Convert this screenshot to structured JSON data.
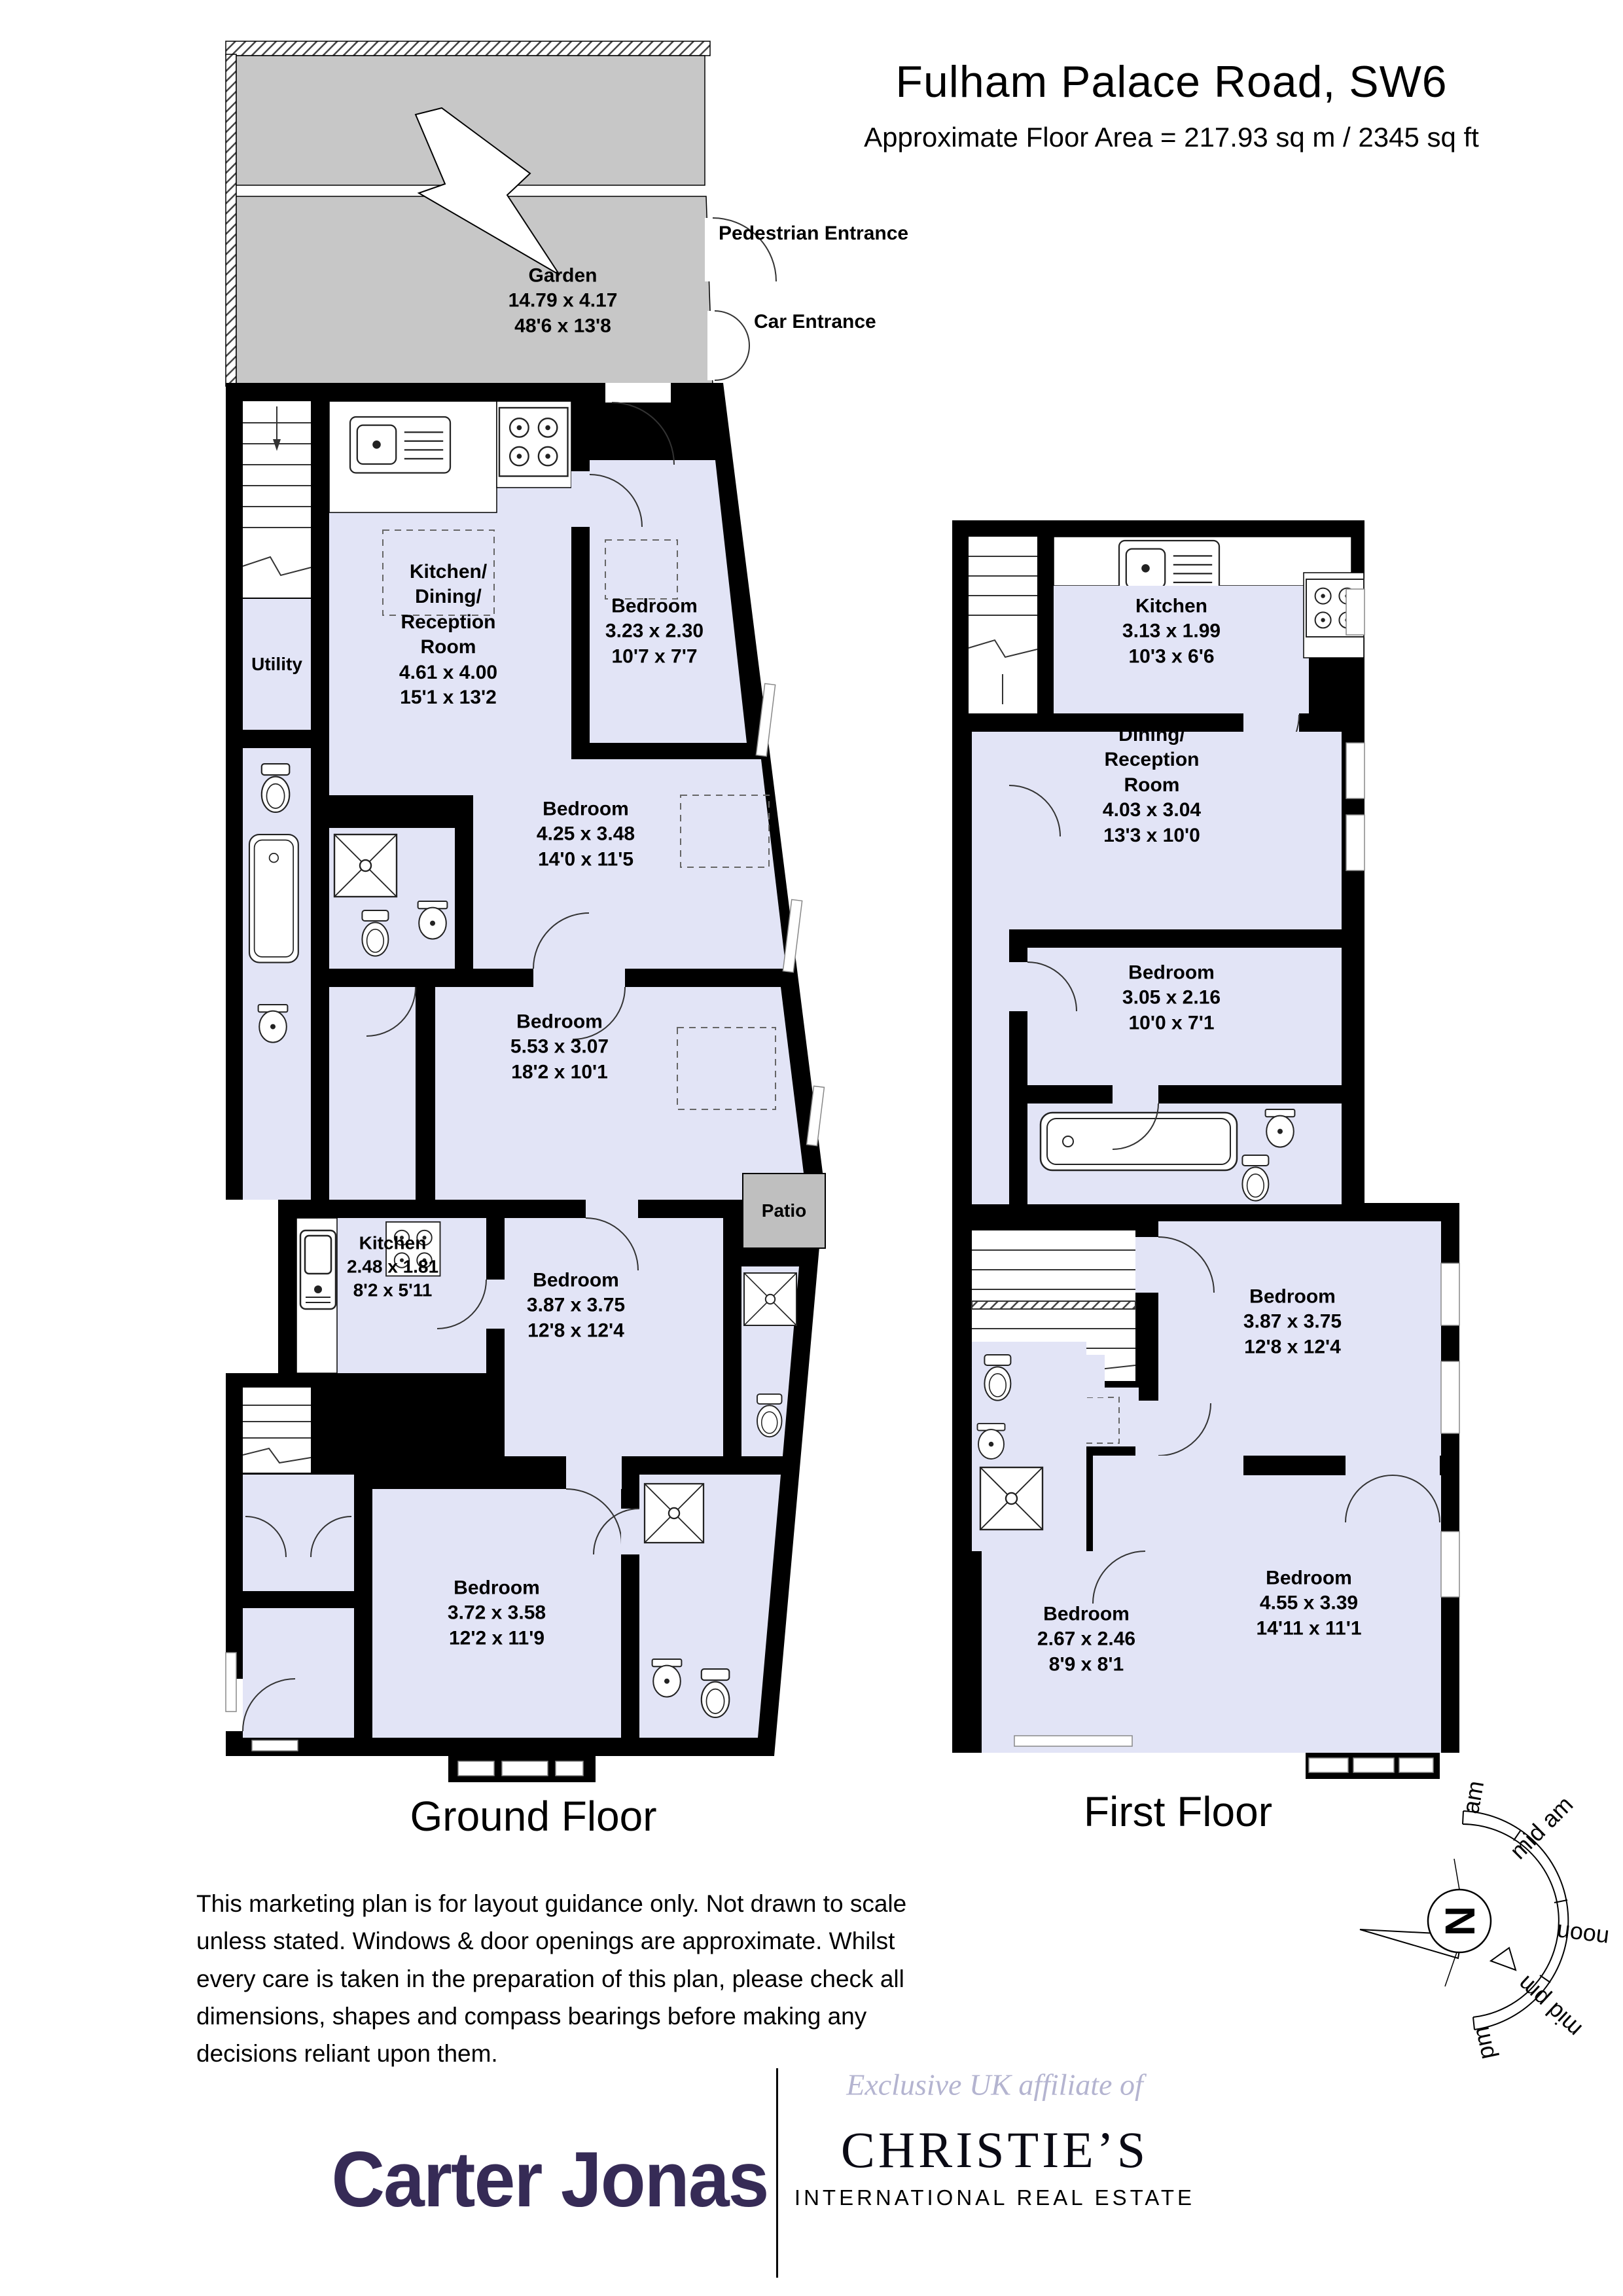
{
  "header": {
    "title": "Fulham Palace Road, SW6",
    "subtitle": "Approximate Floor Area = 217.93 sq m / 2345 sq ft"
  },
  "garden": {
    "name": "Garden",
    "dims_m": "14.79 x 4.17",
    "dims_ft": "48'6 x 13'8"
  },
  "entrances": {
    "pedestrian": "Pedestrian Entrance",
    "car": "Car Entrance"
  },
  "ground_floor": {
    "label": "Ground Floor",
    "rooms": {
      "utility": {
        "name": "Utility"
      },
      "kdr": {
        "name": "Kitchen/\nDining/\nReception\nRoom",
        "dims_m": "4.61 x 4.00",
        "dims_ft": "15'1 x 13'2"
      },
      "bedroom1": {
        "name": "Bedroom",
        "dims_m": "3.23 x 2.30",
        "dims_ft": "10'7 x 7'7"
      },
      "bedroom2": {
        "name": "Bedroom",
        "dims_m": "4.25 x 3.48",
        "dims_ft": "14'0 x 11'5"
      },
      "bedroom3": {
        "name": "Bedroom",
        "dims_m": "5.53 x 3.07",
        "dims_ft": "18'2 x 10'1"
      },
      "kitchen": {
        "name": "Kitchen",
        "dims_m": "2.48 x 1.81",
        "dims_ft": "8'2 x 5'11"
      },
      "patio": {
        "name": "Patio"
      },
      "bedroom4": {
        "name": "Bedroom",
        "dims_m": "3.87 x 3.75",
        "dims_ft": "12'8 x 12'4"
      },
      "bedroom5": {
        "name": "Bedroom",
        "dims_m": "3.72 x 3.58",
        "dims_ft": "12'2 x 11'9"
      }
    }
  },
  "first_floor": {
    "label": "First Floor",
    "rooms": {
      "kitchen": {
        "name": "Kitchen",
        "dims_m": "3.13 x 1.99",
        "dims_ft": "10'3 x 6'6"
      },
      "dining": {
        "name": "Dining/\nReception\nRoom",
        "dims_m": "4.03 x 3.04",
        "dims_ft": "13'3 x 10'0"
      },
      "bedroom1": {
        "name": "Bedroom",
        "dims_m": "3.05 x 2.16",
        "dims_ft": "10'0 x 7'1"
      },
      "bedroom2": {
        "name": "Bedroom",
        "dims_m": "3.87 x 3.75",
        "dims_ft": "12'8 x 12'4"
      },
      "bedroom3": {
        "name": "Bedroom",
        "dims_m": "2.67 x 2.46",
        "dims_ft": "8'9 x 8'1"
      },
      "bedroom4": {
        "name": "Bedroom",
        "dims_m": "4.55 x 3.39",
        "dims_ft": "14'11 x 11'1"
      }
    }
  },
  "disclaimer": "This marketing plan is for layout guidance only. Not drawn to scale unless stated. Windows & door openings are approximate. Whilst every care is taken in the preparation of this plan,  please check all dimensions, shapes and compass bearings before making any decisions reliant upon them.",
  "compass": {
    "north": "N",
    "labels": [
      "am",
      "mid am",
      "noon",
      "mid pm",
      "pm"
    ]
  },
  "footer": {
    "brand": "Carter Jonas",
    "affiliate": "Exclusive UK affiliate of",
    "partner": "CHRISTIE’S",
    "partner_sub": "INTERNATIONAL REAL ESTATE"
  },
  "colors": {
    "room_fill": "#e2e4f6",
    "garden_fill": "#c7c7c7",
    "wall": "#000000",
    "brand": "#362b56",
    "affiliate_text": "#b4b4d0"
  }
}
